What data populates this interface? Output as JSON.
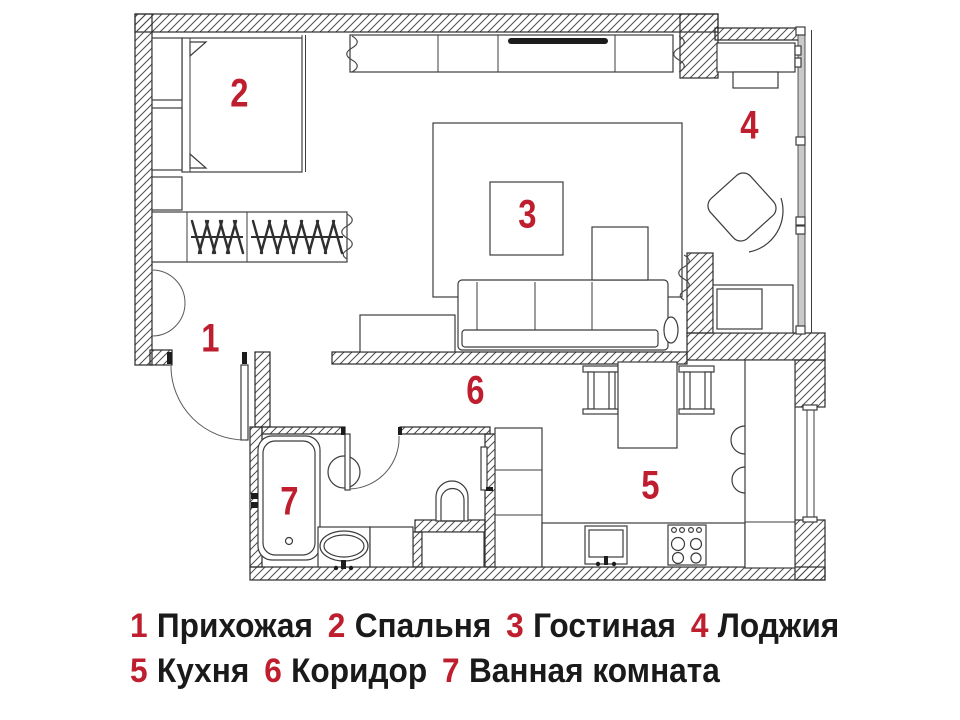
{
  "rooms": [
    {
      "number": "1",
      "name": "Прихожая"
    },
    {
      "number": "2",
      "name": "Спальня"
    },
    {
      "number": "3",
      "name": "Гостиная"
    },
    {
      "number": "4",
      "name": "Лоджия"
    },
    {
      "number": "5",
      "name": "Кухня"
    },
    {
      "number": "6",
      "name": "Коридор"
    },
    {
      "number": "7",
      "name": "Ванная комната"
    }
  ],
  "colors": {
    "accent_red": "#be1e2d",
    "ink": "#1a1a1a",
    "line": "#3c3c3c",
    "background": "#ffffff"
  }
}
